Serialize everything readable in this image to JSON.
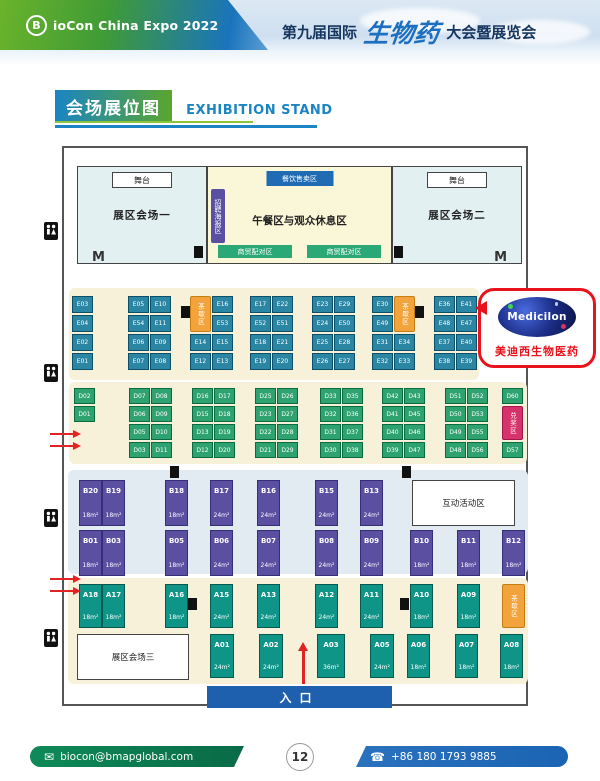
{
  "header": {
    "logo_badge": "B",
    "logo_text": "ioCon China Expo 2022",
    "title_prefix": "第九届国际",
    "title_script": "生物药",
    "title_suffix": "大会暨展览会"
  },
  "section_title": {
    "zh": "会场展位图",
    "en": "EXHIBITION STAND"
  },
  "halls": {
    "stage_label": "舞台",
    "hall1": "展区会场一",
    "hall2": "展区会场二",
    "hall3": "展区会场三",
    "food_sales": "餐饮售卖区",
    "recruit_poster": "招聘海报区",
    "lunch_rest": "午餐区与观众休息区",
    "biz_match": "商贸配对区",
    "interactive_area": "互动活动区",
    "door_label": "M"
  },
  "special_labels": {
    "tea_break": "茶歇区",
    "prize": "兑奖区"
  },
  "e_columns": [
    {
      "cells": [
        [
          "E03"
        ],
        [
          "E04"
        ],
        [
          "E02"
        ],
        [
          "E01"
        ]
      ]
    },
    {
      "cells": [
        [
          "E05",
          "E10"
        ],
        [
          "E54",
          "E11"
        ],
        [
          "E06",
          "E09"
        ],
        [
          "E07",
          "E08"
        ]
      ]
    },
    {
      "cells": [
        [
          null,
          "E16"
        ],
        [
          null,
          "E53"
        ],
        [
          "E14",
          "E15"
        ],
        [
          "E12",
          "E13"
        ]
      ],
      "special": "left"
    },
    {
      "cells": [
        [
          "E17",
          "E22"
        ],
        [
          "E52",
          "E51"
        ],
        [
          "E18",
          "E21"
        ],
        [
          "E19",
          "E20"
        ]
      ]
    },
    {
      "cells": [
        [
          "E23",
          "E29"
        ],
        [
          "E24",
          "E50"
        ],
        [
          "E25",
          "E28"
        ],
        [
          "E26",
          "E27"
        ]
      ]
    },
    {
      "cells": [
        [
          "E30",
          null
        ],
        [
          "E49",
          null
        ],
        [
          "E31",
          "E34"
        ],
        [
          "E32",
          "E33"
        ]
      ],
      "special": "right"
    },
    {
      "cells": [
        [
          "E36",
          "E41"
        ],
        [
          "E48",
          "E47"
        ],
        [
          "E37",
          "E40"
        ],
        [
          "E38",
          "E39"
        ]
      ]
    }
  ],
  "d_columns": [
    {
      "cells": [
        [
          "D02"
        ],
        [
          "D01"
        ]
      ]
    },
    {
      "cells": [
        [
          "D07",
          "D08"
        ],
        [
          "D06",
          "D09"
        ],
        [
          "D05",
          "D10"
        ],
        [
          "D03",
          "D11"
        ]
      ]
    },
    {
      "cells": [
        [
          "D16",
          "D17"
        ],
        [
          "D15",
          "D18"
        ],
        [
          "D13",
          "D19"
        ],
        [
          "D12",
          "D20"
        ]
      ]
    },
    {
      "cells": [
        [
          "D25",
          "D26"
        ],
        [
          "D23",
          "D27"
        ],
        [
          "D22",
          "D28"
        ],
        [
          "D21",
          "D29"
        ]
      ]
    },
    {
      "cells": [
        [
          "D33",
          "D35"
        ],
        [
          "D32",
          "D36"
        ],
        [
          "D31",
          "D37"
        ],
        [
          "D30",
          "D38"
        ]
      ]
    },
    {
      "cells": [
        [
          "D42",
          "D43"
        ],
        [
          "D41",
          "D45"
        ],
        [
          "D40",
          "D46"
        ],
        [
          "D39",
          "D47"
        ]
      ]
    },
    {
      "cells": [
        [
          "D51",
          "D52"
        ],
        [
          "D50",
          "D53"
        ],
        [
          "D49",
          "D55"
        ],
        [
          "D48",
          "D56"
        ]
      ]
    }
  ],
  "d_right": {
    "top": "D60",
    "special": "兑奖区",
    "bottom": "D57"
  },
  "b_top": [
    {
      "id": "B20",
      "size": "18m²"
    },
    {
      "id": "B19",
      "size": "18m²"
    },
    {
      "id": "B18",
      "size": "18m²"
    },
    {
      "id": "B17",
      "size": "24m²"
    },
    {
      "id": "B16",
      "size": "24m²"
    },
    {
      "id": "B15",
      "size": "24m²"
    },
    {
      "id": "B13",
      "size": "24m²"
    }
  ],
  "b_bottom": [
    {
      "id": "B01",
      "size": "18m²"
    },
    {
      "id": "B03",
      "size": "18m²"
    },
    {
      "id": "B05",
      "size": "18m²"
    },
    {
      "id": "B06",
      "size": "24m²"
    },
    {
      "id": "B07",
      "size": "24m²"
    },
    {
      "id": "B08",
      "size": "24m²"
    },
    {
      "id": "B09",
      "size": "24m²"
    },
    {
      "id": "B10",
      "size": "18m²"
    },
    {
      "id": "B11",
      "size": "18m²"
    },
    {
      "id": "B12",
      "size": "18m²"
    }
  ],
  "a_top": [
    {
      "id": "A18",
      "size": "18m²"
    },
    {
      "id": "A17",
      "size": "18m²"
    },
    {
      "id": "A16",
      "size": "18m²"
    },
    {
      "id": "A15",
      "size": "24m²"
    },
    {
      "id": "A13",
      "size": "24m²"
    },
    {
      "id": "A12",
      "size": "24m²"
    },
    {
      "id": "A11",
      "size": "24m²"
    },
    {
      "id": "A10",
      "size": "18m²"
    },
    {
      "id": "A09",
      "size": "18m²"
    }
  ],
  "a_bottom": [
    {
      "id": "A01",
      "size": "24m²"
    },
    {
      "id": "A02",
      "size": "24m²"
    },
    {
      "id": "A03",
      "size": "36m²"
    },
    {
      "id": "A05",
      "size": "24m²"
    },
    {
      "id": "A06",
      "size": "18m²"
    },
    {
      "id": "A07",
      "size": "18m²"
    },
    {
      "id": "A08",
      "size": "18m²"
    }
  ],
  "entrance": "入口",
  "callout": {
    "brand": "Medicilon",
    "caption": "美迪西生物医药"
  },
  "footer": {
    "email": "biocon@bmapglobal.com",
    "page": "12",
    "phone": "+86 180 1793 9885"
  },
  "colors": {
    "e_booth": "#2b86a4",
    "d_booth": "#2ea36f",
    "b_booth": "#5b4fa2",
    "a_booth": "#0f9488",
    "special_orange": "#f2a33c",
    "special_pink": "#d6336c",
    "accent_blue": "#1b84c4",
    "accent_green": "#5aa62d",
    "entrance_blue": "#1e5fae",
    "callout_red": "#e8131d"
  }
}
